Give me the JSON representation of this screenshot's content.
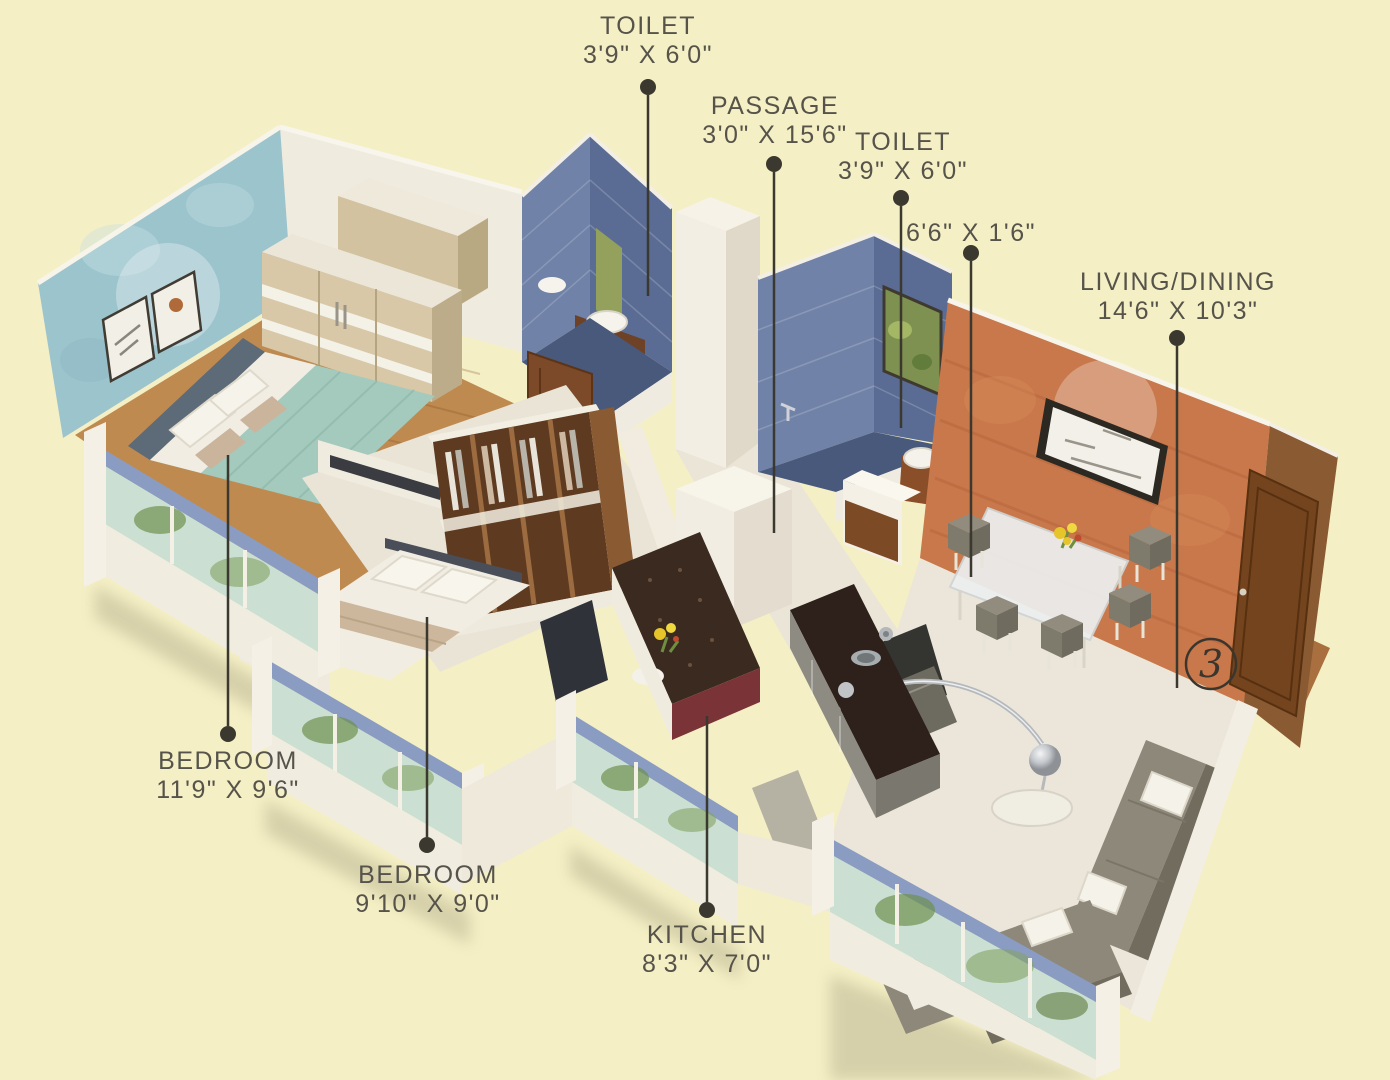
{
  "palette": {
    "background": "#f5efc5",
    "label_text": "#55534a",
    "leader_line": "#3b382f",
    "wall_white": "#f2eee3",
    "feature_wall_blue": "#9cc4cd",
    "feature_wall_orange": "#c8784a",
    "toilet_tile_blue": "#6e80a6",
    "wood_floor": "#bf8a50",
    "window_sill_blue": "#8a9cc2",
    "window_glass": "#cbdfd2",
    "sofa_gray": "#8d887a",
    "door_brown": "#74441f",
    "bed_teal": "#a3cabd"
  },
  "labels": {
    "toilet_top": {
      "room": "TOILET",
      "dims": "3'9\" X 6'0\""
    },
    "passage": {
      "room": "PASSAGE",
      "dims": "3'0\" X 15'6\""
    },
    "toilet_right": {
      "room": "TOILET",
      "dims": "3'9\" X 6'0\""
    },
    "niche": {
      "dims": "6'6\" X 1'6\""
    },
    "living_dining": {
      "room": "LIVING/DINING",
      "dims": "14'6\" X 10'3\""
    },
    "bedroom_left": {
      "room": "BEDROOM",
      "dims": "11'9\" X 9'6\""
    },
    "bedroom_center": {
      "room": "BEDROOM",
      "dims": "9'10\" X 9'0\""
    },
    "kitchen": {
      "room": "KITCHEN",
      "dims": "8'3\" X 7'0\""
    }
  },
  "unit_number": "3"
}
